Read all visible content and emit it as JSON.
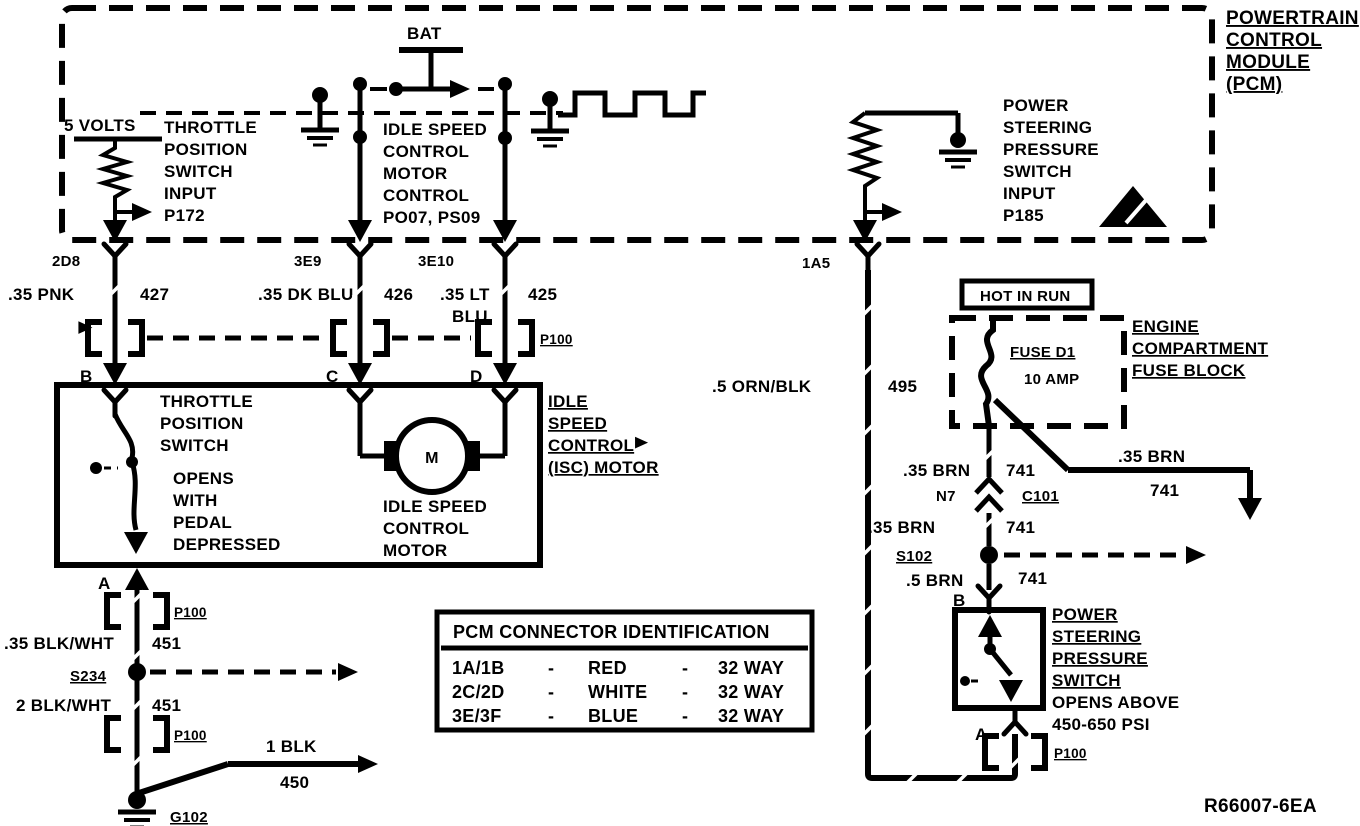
{
  "pcm": {
    "title": [
      "POWERTRAIN",
      "CONTROL",
      "MODULE",
      "(PCM)"
    ],
    "bat": "BAT",
    "five_volts": "5 VOLTS",
    "tps_input": [
      "THROTTLE",
      "POSITION",
      "SWITCH",
      "INPUT",
      "P172"
    ],
    "isc_control": [
      "IDLE SPEED",
      "CONTROL",
      "MOTOR",
      "CONTROL",
      "PO07, PS09"
    ],
    "psps_input": [
      "POWER",
      "STEERING",
      "PRESSURE",
      "SWITCH",
      "INPUT",
      "P185"
    ],
    "pins": {
      "tps": "2D8",
      "isc1": "3E9",
      "isc2": "3E10",
      "psps": "1A5"
    }
  },
  "wires": {
    "pnk427": {
      "spec": ".35 PNK",
      "num": "427"
    },
    "dkblu426": {
      "spec": ".35 DK BLU",
      "num": "426"
    },
    "ltblu425": {
      "spec1": ".35 LT",
      "spec2": "BLU",
      "num": "425"
    },
    "ornblk495": {
      "spec": ".5 ORN/BLK",
      "num": "495"
    },
    "blkwht451a": {
      "spec": ".35 BLK/WHT",
      "num": "451"
    },
    "blkwht451b": {
      "spec": "2 BLK/WHT",
      "num": "451"
    },
    "blk450": {
      "spec": "1 BLK",
      "num": "450"
    },
    "brn741a": {
      "spec": ".35 BRN",
      "num": "741"
    },
    "brn741b": {
      "spec": ".35 BRN",
      "num": "741"
    },
    "brn741c": {
      "spec": ".5 BRN",
      "num": "741"
    },
    "brn741d": {
      "spec": ".35 BRN",
      "num": "741"
    }
  },
  "connectors": {
    "p100": "P100",
    "c101": "C101",
    "n7": "N7"
  },
  "splices": {
    "s234": "S234",
    "s102": "S102"
  },
  "grounds": {
    "g102": "G102"
  },
  "terminals": {
    "tps_b": "B",
    "isc_c": "C",
    "isc_d": "D",
    "tps_a": "A",
    "psps_b": "B",
    "psps_a": "A"
  },
  "tps_box": {
    "switch": [
      "THROTTLE",
      "POSITION",
      "SWITCH"
    ],
    "note": [
      "OPENS",
      "WITH",
      "PEDAL",
      "DEPRESSED"
    ],
    "motor": [
      "IDLE SPEED",
      "CONTROL",
      "MOTOR"
    ],
    "motor_letter": "M"
  },
  "isc_callout": [
    "IDLE",
    "SPEED",
    "CONTROL",
    "(ISC) MOTOR"
  ],
  "fuse_block": {
    "hot_in_run": "HOT IN RUN",
    "fuse_name": "FUSE D1",
    "fuse_amp": "10 AMP",
    "callout": [
      "ENGINE",
      "COMPARTMENT",
      "FUSE BLOCK"
    ]
  },
  "psps": {
    "callout": [
      "POWER",
      "STEERING",
      "PRESSURE",
      "SWITCH"
    ],
    "note": [
      "OPENS ABOVE",
      "450-650 PSI"
    ]
  },
  "table": {
    "title": "PCM CONNECTOR IDENTIFICATION",
    "rows": [
      {
        "conn": "1A/1B",
        "d1": "-",
        "color": "RED",
        "d2": "-",
        "way": "32 WAY"
      },
      {
        "conn": "2C/2D",
        "d1": "-",
        "color": "WHITE",
        "d2": "-",
        "way": "32 WAY"
      },
      {
        "conn": "3E/3F",
        "d1": "-",
        "color": "BLUE",
        "d2": "-",
        "way": "32 WAY"
      }
    ]
  },
  "ref_number": "R66007-6EA",
  "colors": {
    "ink": "#000000",
    "paper": "#ffffff",
    "halftone": "#d6d6d6"
  }
}
